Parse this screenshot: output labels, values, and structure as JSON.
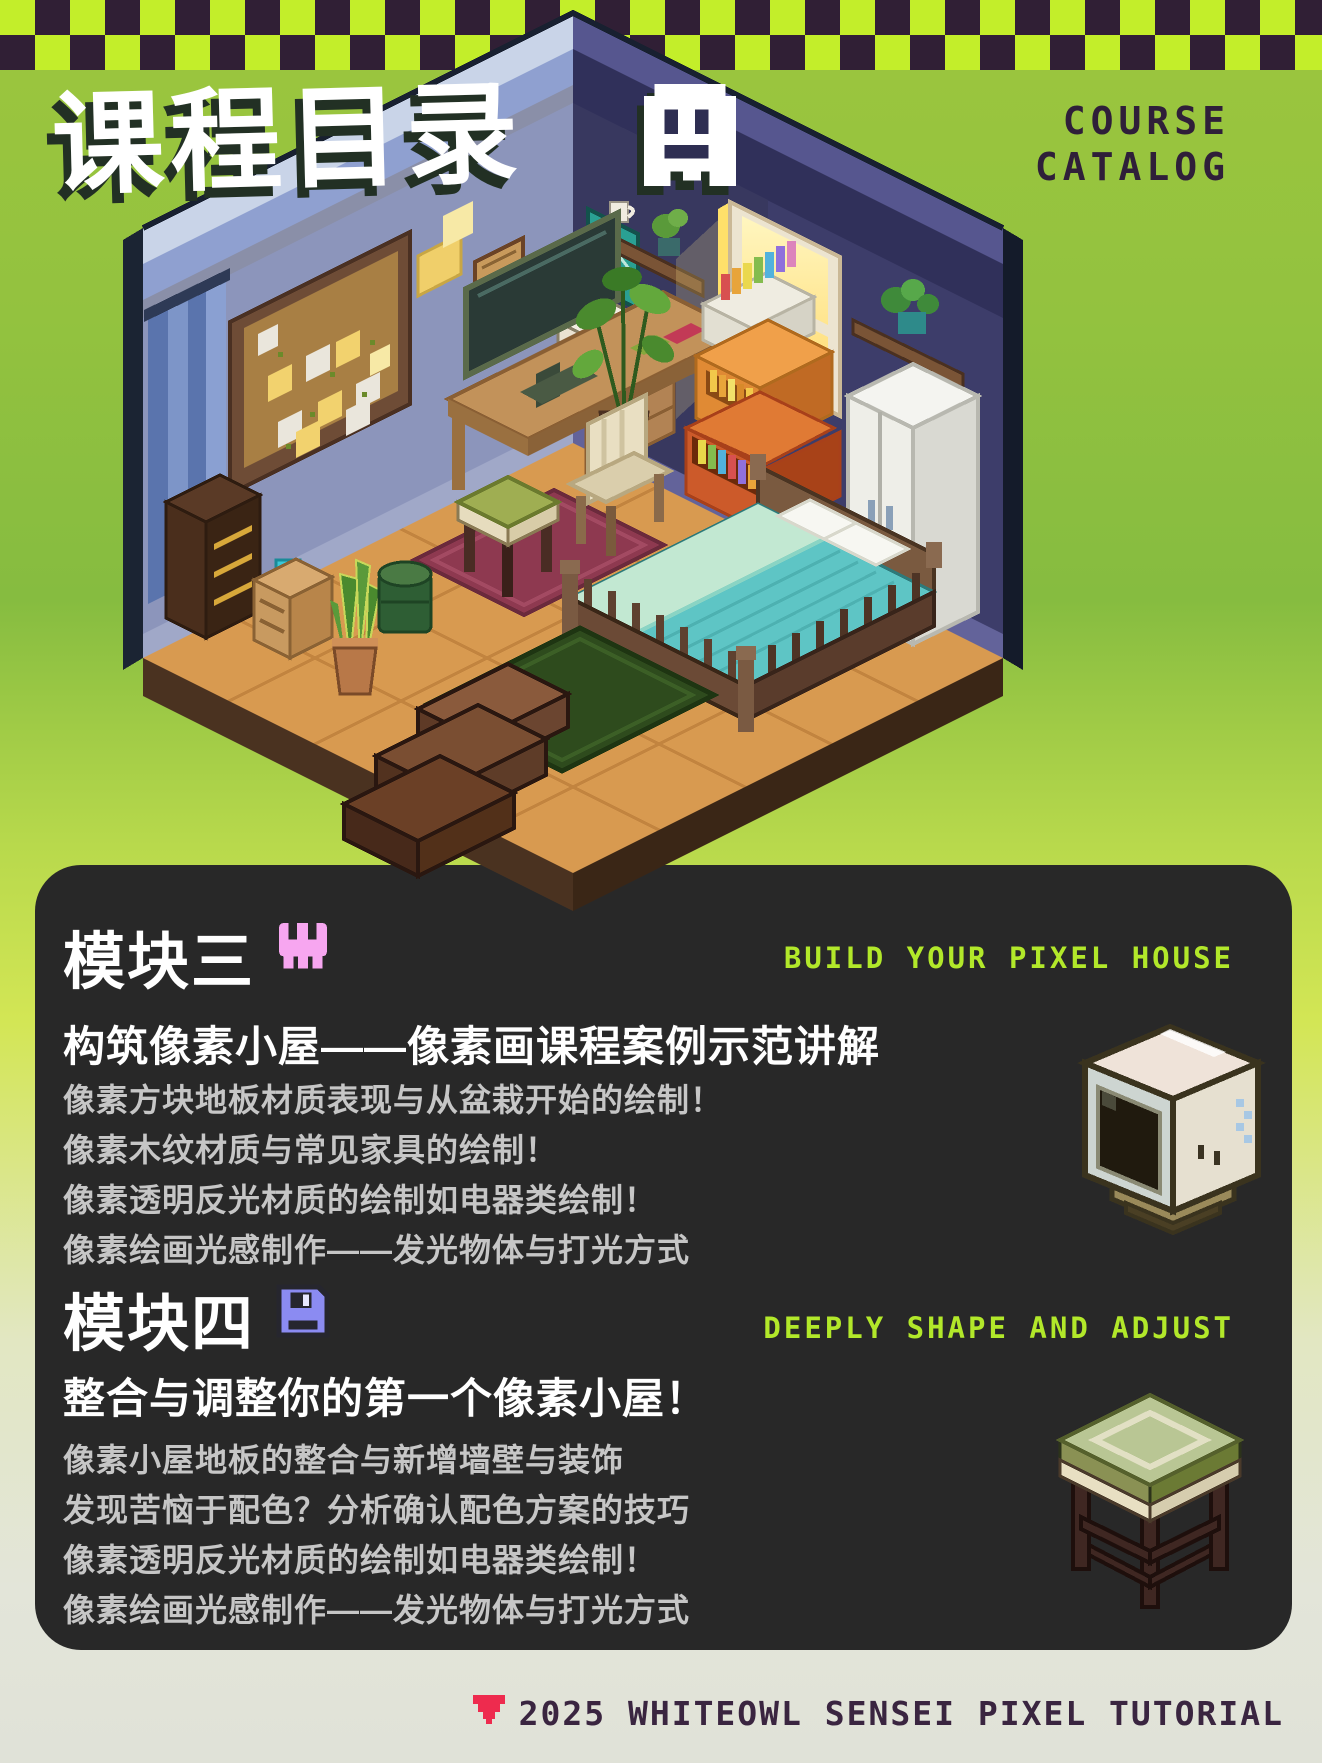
{
  "header": {
    "title": "课程目录",
    "title_icon": "pixel-ghost-icon",
    "catalog_label_line1": "COURSE",
    "catalog_label_line2": "CATALOG"
  },
  "illustration": {
    "alt": "Isometric pixel-art bedroom with corkboard, desk, monitor, bed, wardrobe, plants, bookshelf crates, glowing window and steps"
  },
  "modules": [
    {
      "heading": "模块三",
      "icon": "skull-icon",
      "tagline": "BUILD YOUR PIXEL HOUSE",
      "subtitle": "构筑像素小屋——像素画课程案例示范讲解",
      "lines": [
        "像素方块地板材质表现与从盆栽开始的绘制！",
        "像素木纹材质与常见家具的绘制！",
        "像素透明反光材质的绘制如电器类绘制！",
        "像素绘画光感制作——发光物体与打光方式"
      ],
      "art": "crt-tv-pixel-art"
    },
    {
      "heading": "模块四",
      "icon": "floppy-disk-icon",
      "tagline": "DEEPLY SHAPE AND ADJUST",
      "subtitle": "整合与调整你的第一个像素小屋！",
      "lines": [
        "像素小屋地板的整合与新增墙壁与装饰",
        "发现苦恼于配色？分析确认配色方案的技巧",
        "像素透明反光材质的绘制如电器类绘制！",
        "像素绘画光感制作——发光物体与打光方式"
      ],
      "art": "stool-pixel-art"
    }
  ],
  "footer": {
    "icon": "down-triangle-icon",
    "text": "2025 WHITEOWL SENSEI PIXEL TUTORIAL"
  },
  "colors": {
    "background_top": "#9cc63e",
    "checker_lime": "#c3ee2a",
    "checker_dark": "#301f35",
    "panel": "#282828",
    "accent_lime": "#b2e82a",
    "skull_pink": "#f7a6f0",
    "floppy_purple": "#8b8bf2",
    "triangle_red": "#ee2b4e",
    "catalog_text": "#2f1f39",
    "footer_text": "#3a2540"
  }
}
